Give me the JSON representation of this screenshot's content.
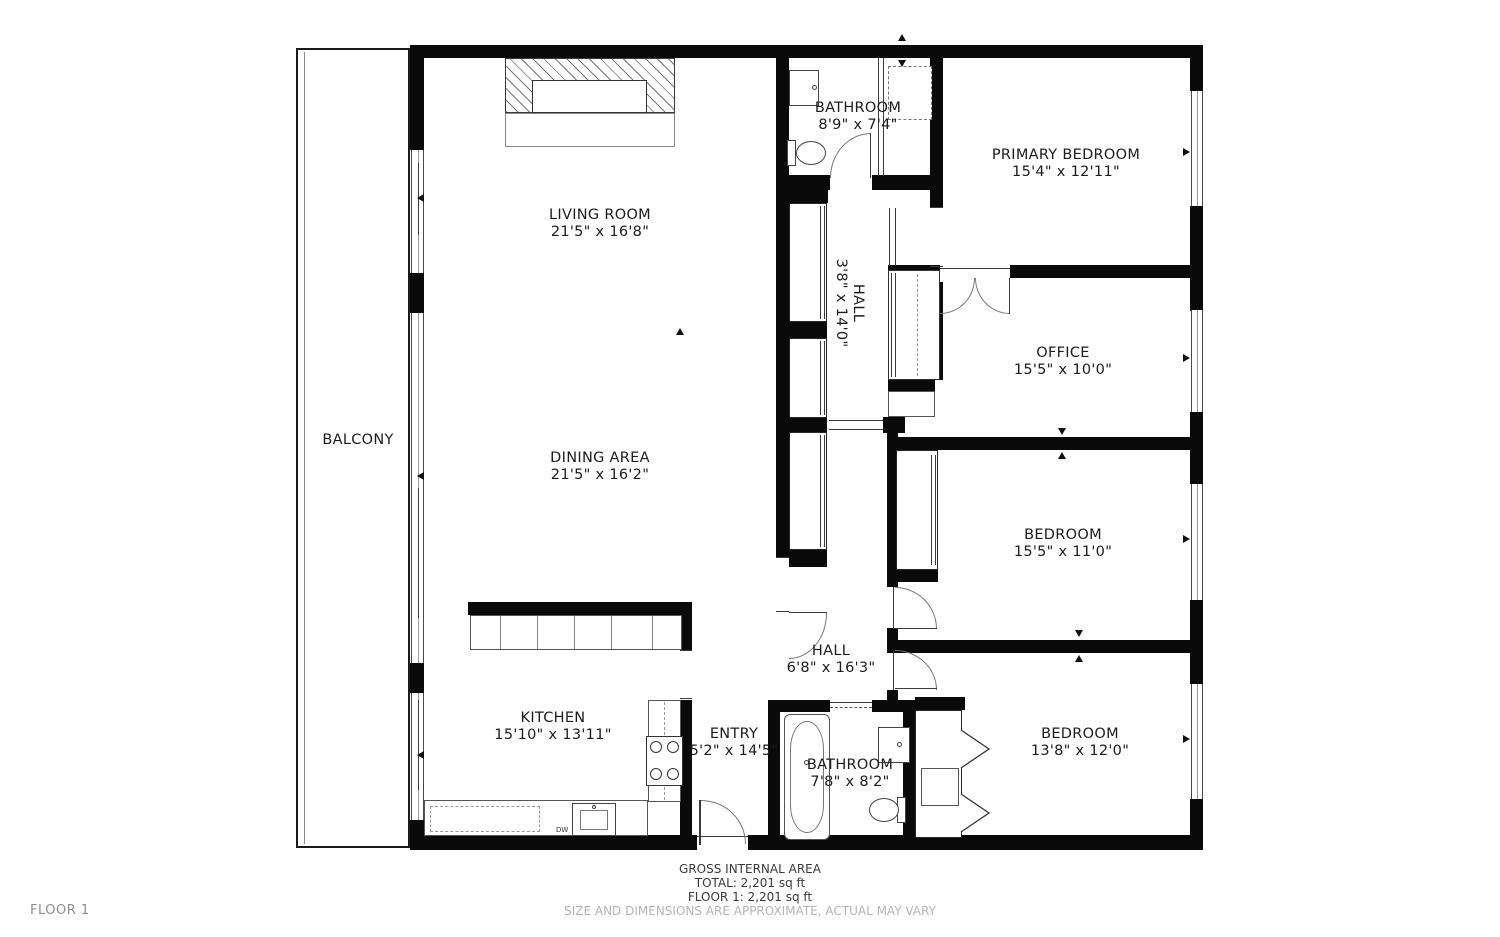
{
  "floorplan": {
    "rooms": [
      {
        "id": "living-room",
        "name": "LIVING ROOM",
        "dims": "21'5\" x 16'8\""
      },
      {
        "id": "dining-area",
        "name": "DINING AREA",
        "dims": "21'5\" x 16'2\""
      },
      {
        "id": "kitchen",
        "name": "KITCHEN",
        "dims": "15'10\" x 13'11\""
      },
      {
        "id": "entry",
        "name": "ENTRY",
        "dims": "5'2\" x 14'5\""
      },
      {
        "id": "bathroom-lower",
        "name": "BATHROOM",
        "dims": "7'8\" x 8'2\""
      },
      {
        "id": "hall-lower",
        "name": "HALL",
        "dims": "6'8\" x 16'3\""
      },
      {
        "id": "bedroom-lower",
        "name": "BEDROOM",
        "dims": "13'8\" x 12'0\""
      },
      {
        "id": "bedroom-mid",
        "name": "BEDROOM",
        "dims": "15'5\" x 11'0\""
      },
      {
        "id": "office",
        "name": "OFFICE",
        "dims": "15'5\" x 10'0\""
      },
      {
        "id": "primary-bedroom",
        "name": "PRIMARY BEDROOM",
        "dims": "15'4\" x 12'11\""
      },
      {
        "id": "bathroom-upper",
        "name": "BATHROOM",
        "dims": "8'9\" x 7'4\""
      },
      {
        "id": "hall-upper",
        "name": "HALL",
        "dims": "3'8\" x 14'0\""
      },
      {
        "id": "balcony",
        "name": "BALCONY",
        "dims": ""
      }
    ],
    "kitchen_labels": {
      "dishwasher": "DW"
    },
    "footer": {
      "title": "GROSS INTERNAL AREA",
      "total": "TOTAL: 2,201 sq ft",
      "floor1": "FLOOR 1: 2,201 sq ft",
      "disclaimer": "SIZE AND DIMENSIONS ARE APPROXIMATE, ACTUAL MAY VARY"
    },
    "floor_label": "FLOOR 1",
    "colors": {
      "wall": "#0a0a0a",
      "fixture": "#6a6a6a",
      "muted": "#b5b5b5",
      "text": "#1c1c1c"
    }
  }
}
